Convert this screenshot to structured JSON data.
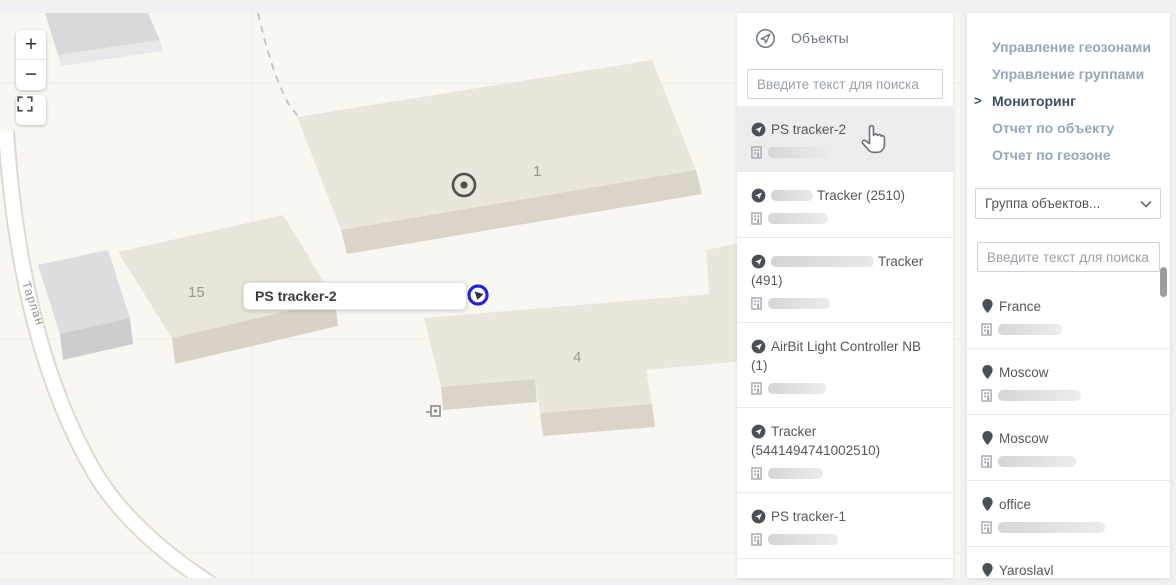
{
  "colors": {
    "marker_blue": "#2626d9",
    "menu_muted": "#95a7b9",
    "menu_active": "#3e4f60",
    "map_bg": "#f8f7f1"
  },
  "map": {
    "zoom_in_label": "+",
    "zoom_out_label": "−",
    "street_label": "Тарлан",
    "buildings": [
      {
        "label": "1"
      },
      {
        "label": "15"
      },
      {
        "label": "4"
      }
    ],
    "tooltip_text": "PS tracker-2"
  },
  "objects_panel": {
    "title": "Объекты",
    "search_placeholder": "Введите текст для поиска",
    "items": [
      {
        "name": "PS tracker-2",
        "selected": true,
        "redacted_prefix": false
      },
      {
        "name": "Tracker (2510)",
        "selected": false,
        "redacted_prefix": true
      },
      {
        "name": "Tracker (491)",
        "selected": false,
        "redacted_prefix": true
      },
      {
        "name": "AirBit Light Controller NB (1)",
        "selected": false,
        "redacted_prefix": false
      },
      {
        "name": "Tracker (5441494741002510)",
        "selected": false,
        "redacted_prefix": false
      },
      {
        "name": "PS tracker-1",
        "selected": false,
        "redacted_prefix": false
      }
    ]
  },
  "nav_panel": {
    "menu": [
      {
        "label": "Управление геозонами",
        "active": false
      },
      {
        "label": "Управление группами",
        "active": false
      },
      {
        "label": "Мониторинг",
        "active": true
      },
      {
        "label": "Отчет по объекту",
        "active": false
      },
      {
        "label": "Отчет по геозоне",
        "active": false
      }
    ],
    "active_chevron": ">",
    "group_select_value": "Группа объектов...",
    "search_placeholder": "Введите текст для поиска",
    "geofences": [
      {
        "name": "France"
      },
      {
        "name": "Moscow"
      },
      {
        "name": "Moscow"
      },
      {
        "name": "office"
      },
      {
        "name": "Yaroslavl"
      }
    ]
  }
}
